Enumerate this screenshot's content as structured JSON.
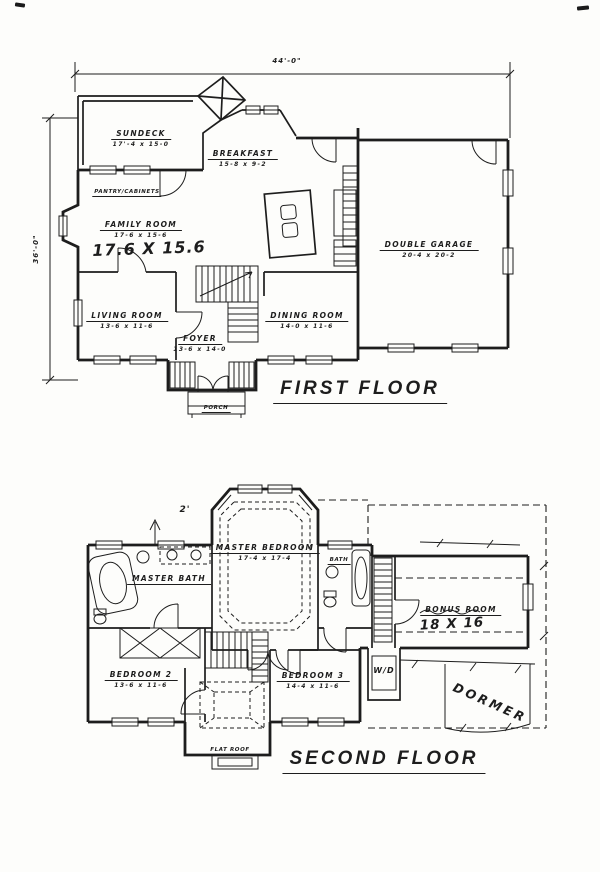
{
  "drawing": {
    "ink_color": "#1d1d1d",
    "paper_color": "#fdfdfb"
  },
  "first_floor": {
    "title": "FIRST FLOOR",
    "overall_width": "44'-0\"",
    "overall_depth": "36'-0\"",
    "rooms": {
      "sundeck": {
        "label": "SUNDECK",
        "size": "17'-4 x 15-0"
      },
      "breakfast": {
        "label": "BREAKFAST",
        "size": "15-8 x 9-2"
      },
      "family_room": {
        "label": "FAMILY ROOM",
        "size": "17-6 x 15-6",
        "handwritten_size": "17.6 X 15.6"
      },
      "living_room": {
        "label": "LIVING ROOM",
        "size": "13-6 x 11-6"
      },
      "dining_room": {
        "label": "DINING ROOM",
        "size": "14-0 x 11-6"
      },
      "foyer": {
        "label": "FOYER",
        "size": "13-6 x 14-0"
      },
      "porch": {
        "label": "PORCH"
      },
      "double_garage": {
        "label": "DOUBLE GARAGE",
        "size": "20-4 x 20-2"
      }
    },
    "annotations": {
      "pantry_note": "PANTRY/CABINETS"
    }
  },
  "second_floor": {
    "title": "SECOND FLOOR",
    "rooms": {
      "master_bedroom": {
        "label": "MASTER BEDROOM",
        "size": "17-4 x 17-4"
      },
      "master_bath": {
        "label": "MASTER BATH"
      },
      "bath": {
        "label": "BATH"
      },
      "bonus_room": {
        "label": "BONUS ROOM",
        "handwritten_size": "18 X 16"
      },
      "bedroom_2": {
        "label": "BEDROOM 2",
        "size": "13-6 x 11-6"
      },
      "bedroom_3": {
        "label": "BEDROOM 3",
        "size": "14-4 x 11-6"
      },
      "laundry_closet": {
        "label": "W/D"
      }
    },
    "annotations": {
      "bay_offset": "2'",
      "dormer": "DORMER",
      "flat_roof": "FLAT ROOF"
    }
  }
}
